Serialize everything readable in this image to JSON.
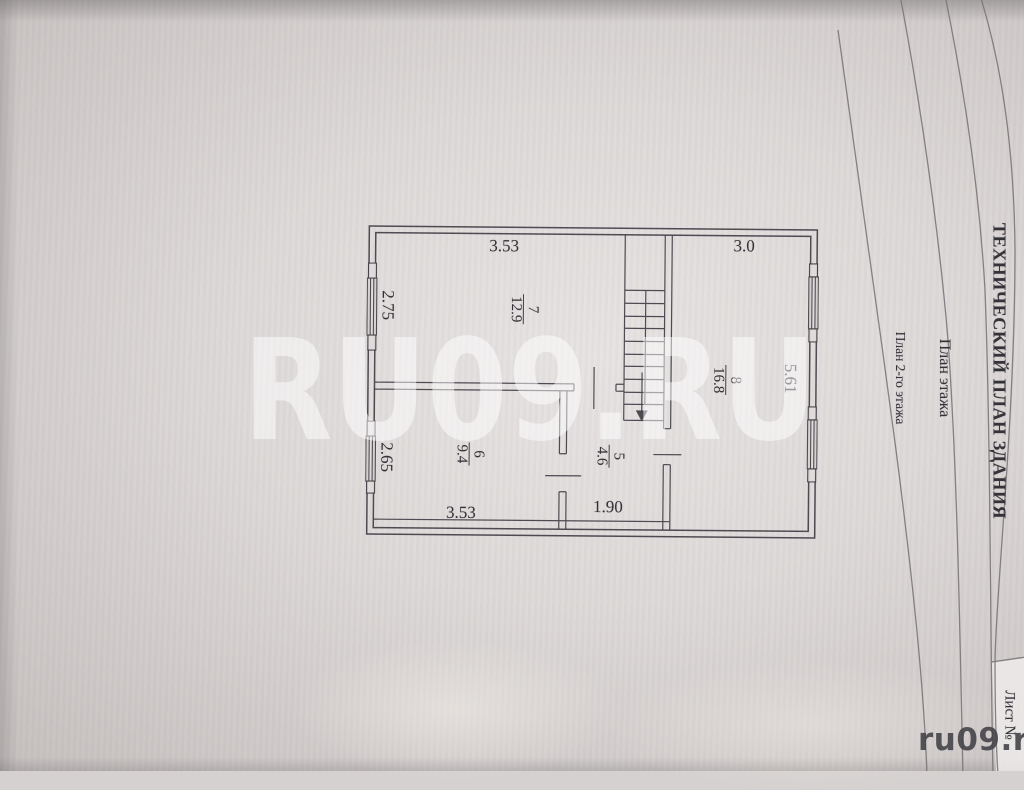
{
  "page": {
    "watermark_large": "RU09.RU",
    "watermark_corner": "ru09.ru"
  },
  "title_block": {
    "document_title": "ТЕХНИЧЕСКИЙ ПЛАН ЗДАНИЯ",
    "section_title": "План этажа",
    "drawing_caption": "План 2-го этажа",
    "sheet_label": "Лист №"
  },
  "floor_plan": {
    "dimensions": {
      "top_left_width": "3.53",
      "top_right_width": "3.0",
      "left_upper_height": "2.75",
      "left_lower_height": "2.65",
      "right_height": "5.61",
      "bottom_left_width": "3.53",
      "bottom_middle_width": "1.90"
    },
    "rooms": {
      "room7": {
        "number": "7",
        "area": "12.9"
      },
      "room8": {
        "number": "8",
        "area": "16.8"
      },
      "room6": {
        "number": "6",
        "area": "9.4"
      },
      "room5": {
        "number": "5",
        "area": "4.6"
      }
    }
  },
  "colors": {
    "paper": "#ddd9d8",
    "ink": "#413f46",
    "rule_line": "#7b777a",
    "watermark": "#ffffff",
    "corner_mark": "#454449"
  }
}
